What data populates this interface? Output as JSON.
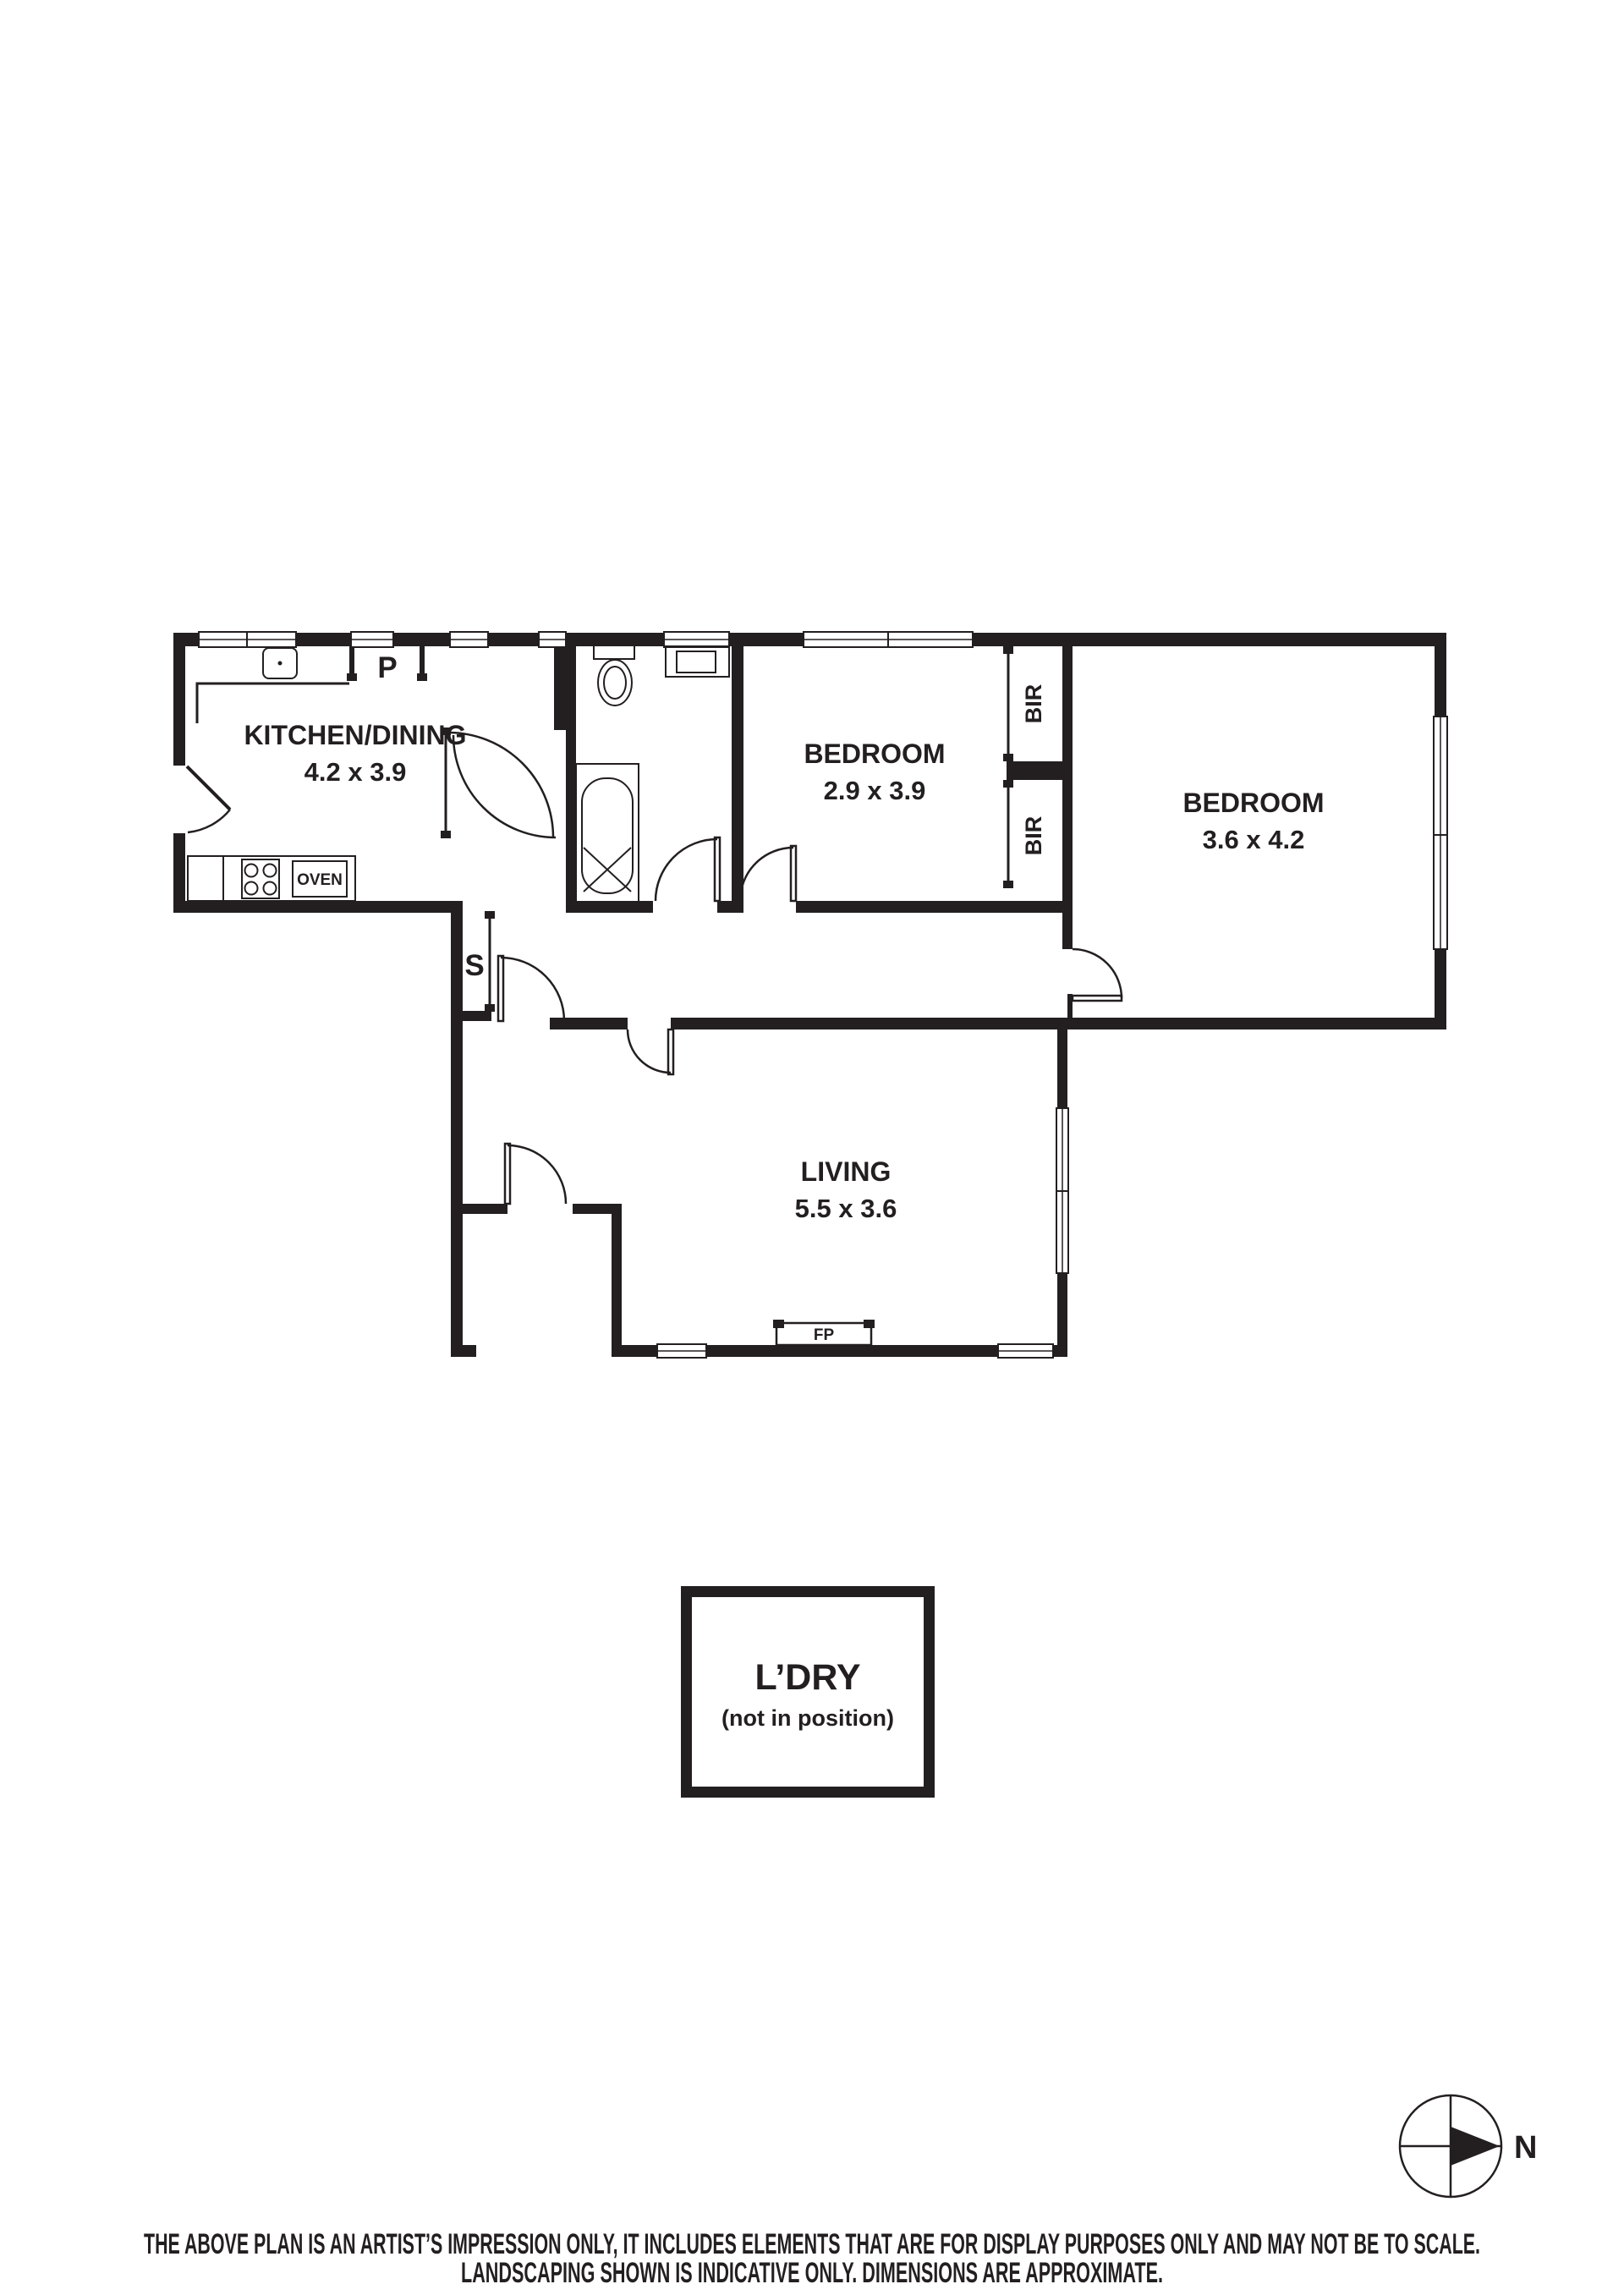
{
  "plan": {
    "rooms": [
      {
        "name": "KITCHEN/DINING",
        "dims": "4.2 x 3.9"
      },
      {
        "name": "BEDROOM",
        "dims": "2.9 x 3.9"
      },
      {
        "name": "BEDROOM",
        "dims": "3.6 x 4.2"
      },
      {
        "name": "LIVING",
        "dims": "5.5 x 3.6"
      }
    ],
    "labels": {
      "pantry": "P",
      "storage": "S",
      "oven": "OVEN",
      "fireplace": "FP",
      "bir_top": "BIR",
      "bir_bottom": "BIR"
    },
    "laundry": {
      "title": "L’DRY",
      "note": "(not in position)"
    }
  },
  "compass": {
    "label": "N"
  },
  "disclaimer": {
    "line1": "THE ABOVE PLAN IS AN ARTIST’S IMPRESSION ONLY, IT INCLUDES ELEMENTS THAT ARE FOR DISPLAY PURPOSES ONLY AND MAY NOT BE TO SCALE.",
    "line2": "LANDSCAPING SHOWN IS INDICATIVE ONLY. DIMENSIONS ARE APPROXIMATE."
  },
  "colors": {
    "ink": "#231f20",
    "background": "#ffffff"
  }
}
